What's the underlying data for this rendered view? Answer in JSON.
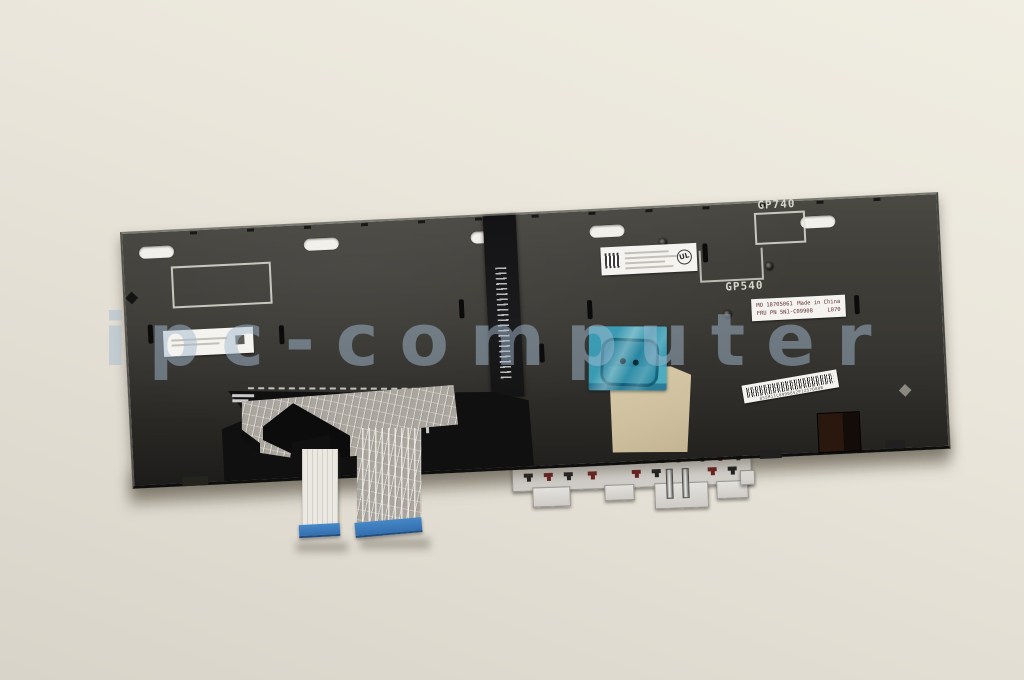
{
  "image": {
    "subject": "laptop keyboard rear view product photo"
  },
  "watermark": {
    "text": "ipc-computer"
  },
  "plate": {
    "marking_gp740": "GP740",
    "marking_gp540": "GP540"
  },
  "labels": {
    "info_line1_left": "MO 18705061",
    "info_line1_right": "Made in China",
    "info_line2_left": "FRU PN 5N1-C09908",
    "info_line2_right": "L070",
    "ul_logo": "UL",
    "barcode_text": "8S5M11C09908S2P1Z57D00B"
  },
  "colors": {
    "background": "#e7e3d8",
    "plate": "#35342f",
    "tape_teal": "#3aa8c4",
    "stiffener_blue": "#3b7cbd",
    "bracket_gray": "#d9d7d3",
    "pad_red": "#6e1e1e",
    "watermark_blue": "#a3bacf"
  }
}
